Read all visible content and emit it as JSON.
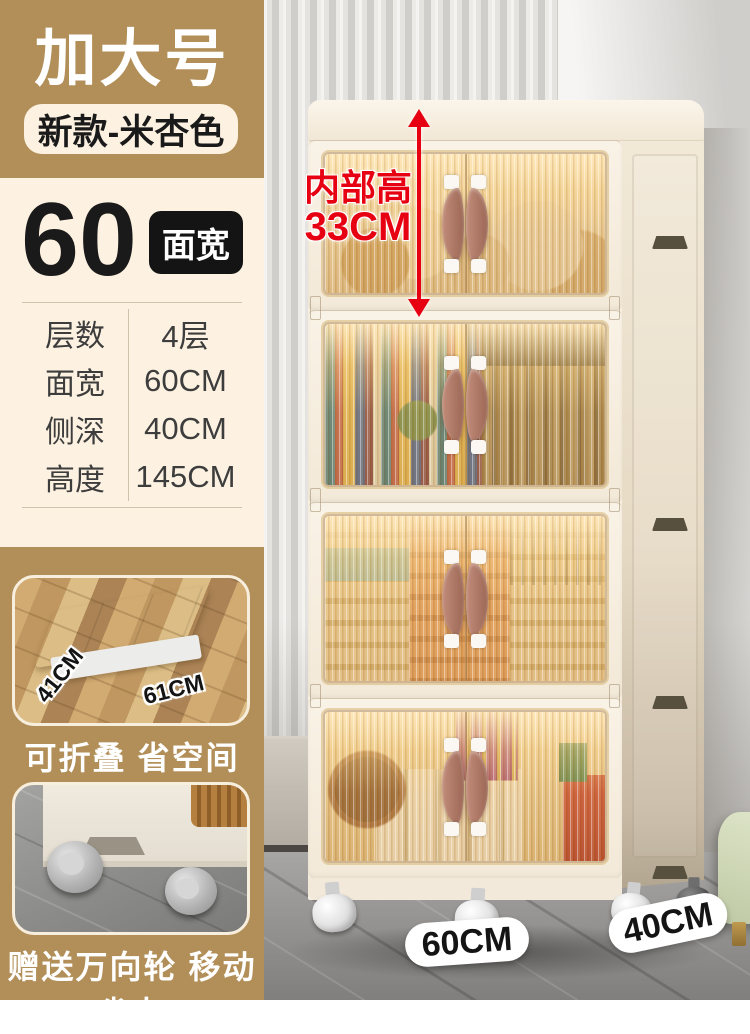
{
  "colors": {
    "tan": "#b28f58",
    "cream_bg": "#fdf2e1",
    "accent_red": "#e60012",
    "badge_black": "#141414",
    "handle_brown": "#b07a68",
    "door_amber": "#e2ab60"
  },
  "sidebar": {
    "title_badge": "加大号",
    "subtitle_pill": "新款-米杏色",
    "size": {
      "number": "60",
      "unit": "面宽"
    },
    "spec": {
      "rows": [
        {
          "label": "层数",
          "value": "4层"
        },
        {
          "label": "面宽",
          "value": "60CM"
        },
        {
          "label": "侧深",
          "value": "40CM"
        },
        {
          "label": "高度",
          "value": "145CM"
        }
      ]
    },
    "feature_fold": {
      "dim_side": "41CM",
      "dim_front": "61CM",
      "caption": "可折叠 省空间"
    },
    "feature_wheels": {
      "caption": "赠送万向轮 移动省力"
    }
  },
  "main": {
    "annotation": {
      "line1": "内部高",
      "line2": "33CM"
    },
    "floor_badges": {
      "width": "60CM",
      "depth": "40CM"
    },
    "tier_count": 4
  }
}
